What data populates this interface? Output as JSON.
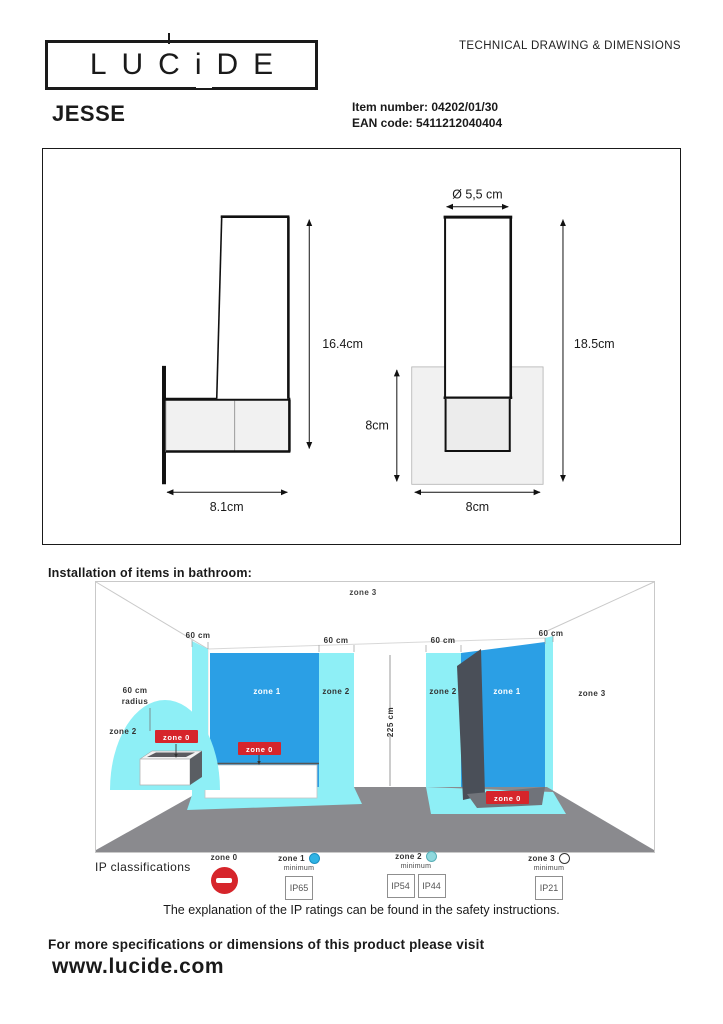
{
  "header": {
    "logo_text": "LUCiDE",
    "doc_title": "TECHNICAL DRAWING & DIMENSIONS"
  },
  "product": {
    "name": "JESSE",
    "item_number_label": "Item number:",
    "item_number": "04202/01/30",
    "ean_label": "EAN code:",
    "ean": "5411212040404"
  },
  "drawing": {
    "side_view": {
      "height": "16.4cm",
      "width": "8.1cm"
    },
    "front_view": {
      "diameter": "Ø 5,5 cm",
      "height": "18.5cm",
      "base_height": "8cm",
      "base_width": "8cm"
    }
  },
  "bathroom": {
    "title": "Installation of items in bathroom:",
    "labels": {
      "zone0": "zone 0",
      "zone1": "zone 1",
      "zone2": "zone 2",
      "zone3": "zone 3",
      "dim60": "60 cm",
      "radius_line1": "60 cm",
      "radius_line2": "radius",
      "dim225": "225 cm"
    }
  },
  "ip": {
    "title": "IP classifications",
    "zones": [
      {
        "label": "zone 0",
        "minimum": "",
        "ratings": []
      },
      {
        "label": "zone 1",
        "minimum": "minimum",
        "ratings": [
          "IP65"
        ]
      },
      {
        "label": "zone 2",
        "minimum": "minimum",
        "ratings": [
          "IP54",
          "IP44"
        ]
      },
      {
        "label": "zone 3",
        "minimum": "minimum",
        "ratings": [
          "IP21"
        ]
      }
    ],
    "note": "The explanation of the IP ratings can be found in the safety instructions."
  },
  "footer": {
    "line1": "For more specifications or dimensions of this product please visit",
    "url": "www.lucide.com"
  },
  "colors": {
    "zone1_blue": "#2B9FE5",
    "zone2_cyan": "#8EEFF6",
    "zone0_red": "#D6252B",
    "floor_grey": "#8A8A8E",
    "shower_panel_dark": "#4A4F58",
    "drawing_fill_grey": "#F1F1F1"
  }
}
